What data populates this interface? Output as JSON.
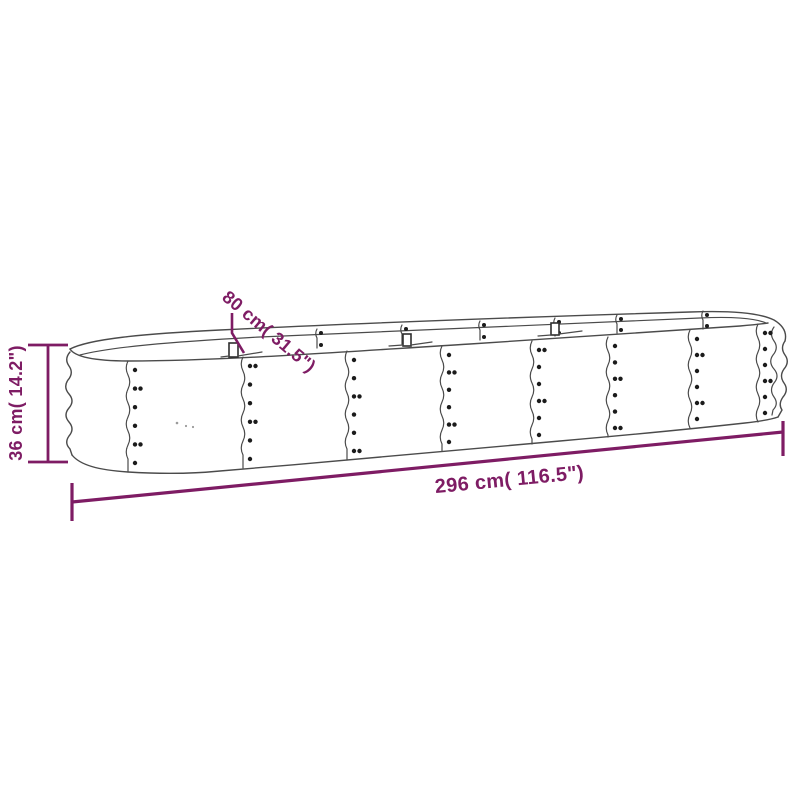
{
  "diagram": {
    "accent_color": "#7e1c64",
    "line_color": "#4b4b4b",
    "labels": {
      "length": "296 cm( 116.5\")",
      "width": "80 cm( 31.5\")",
      "height": "36 cm( 14.2\")"
    }
  }
}
